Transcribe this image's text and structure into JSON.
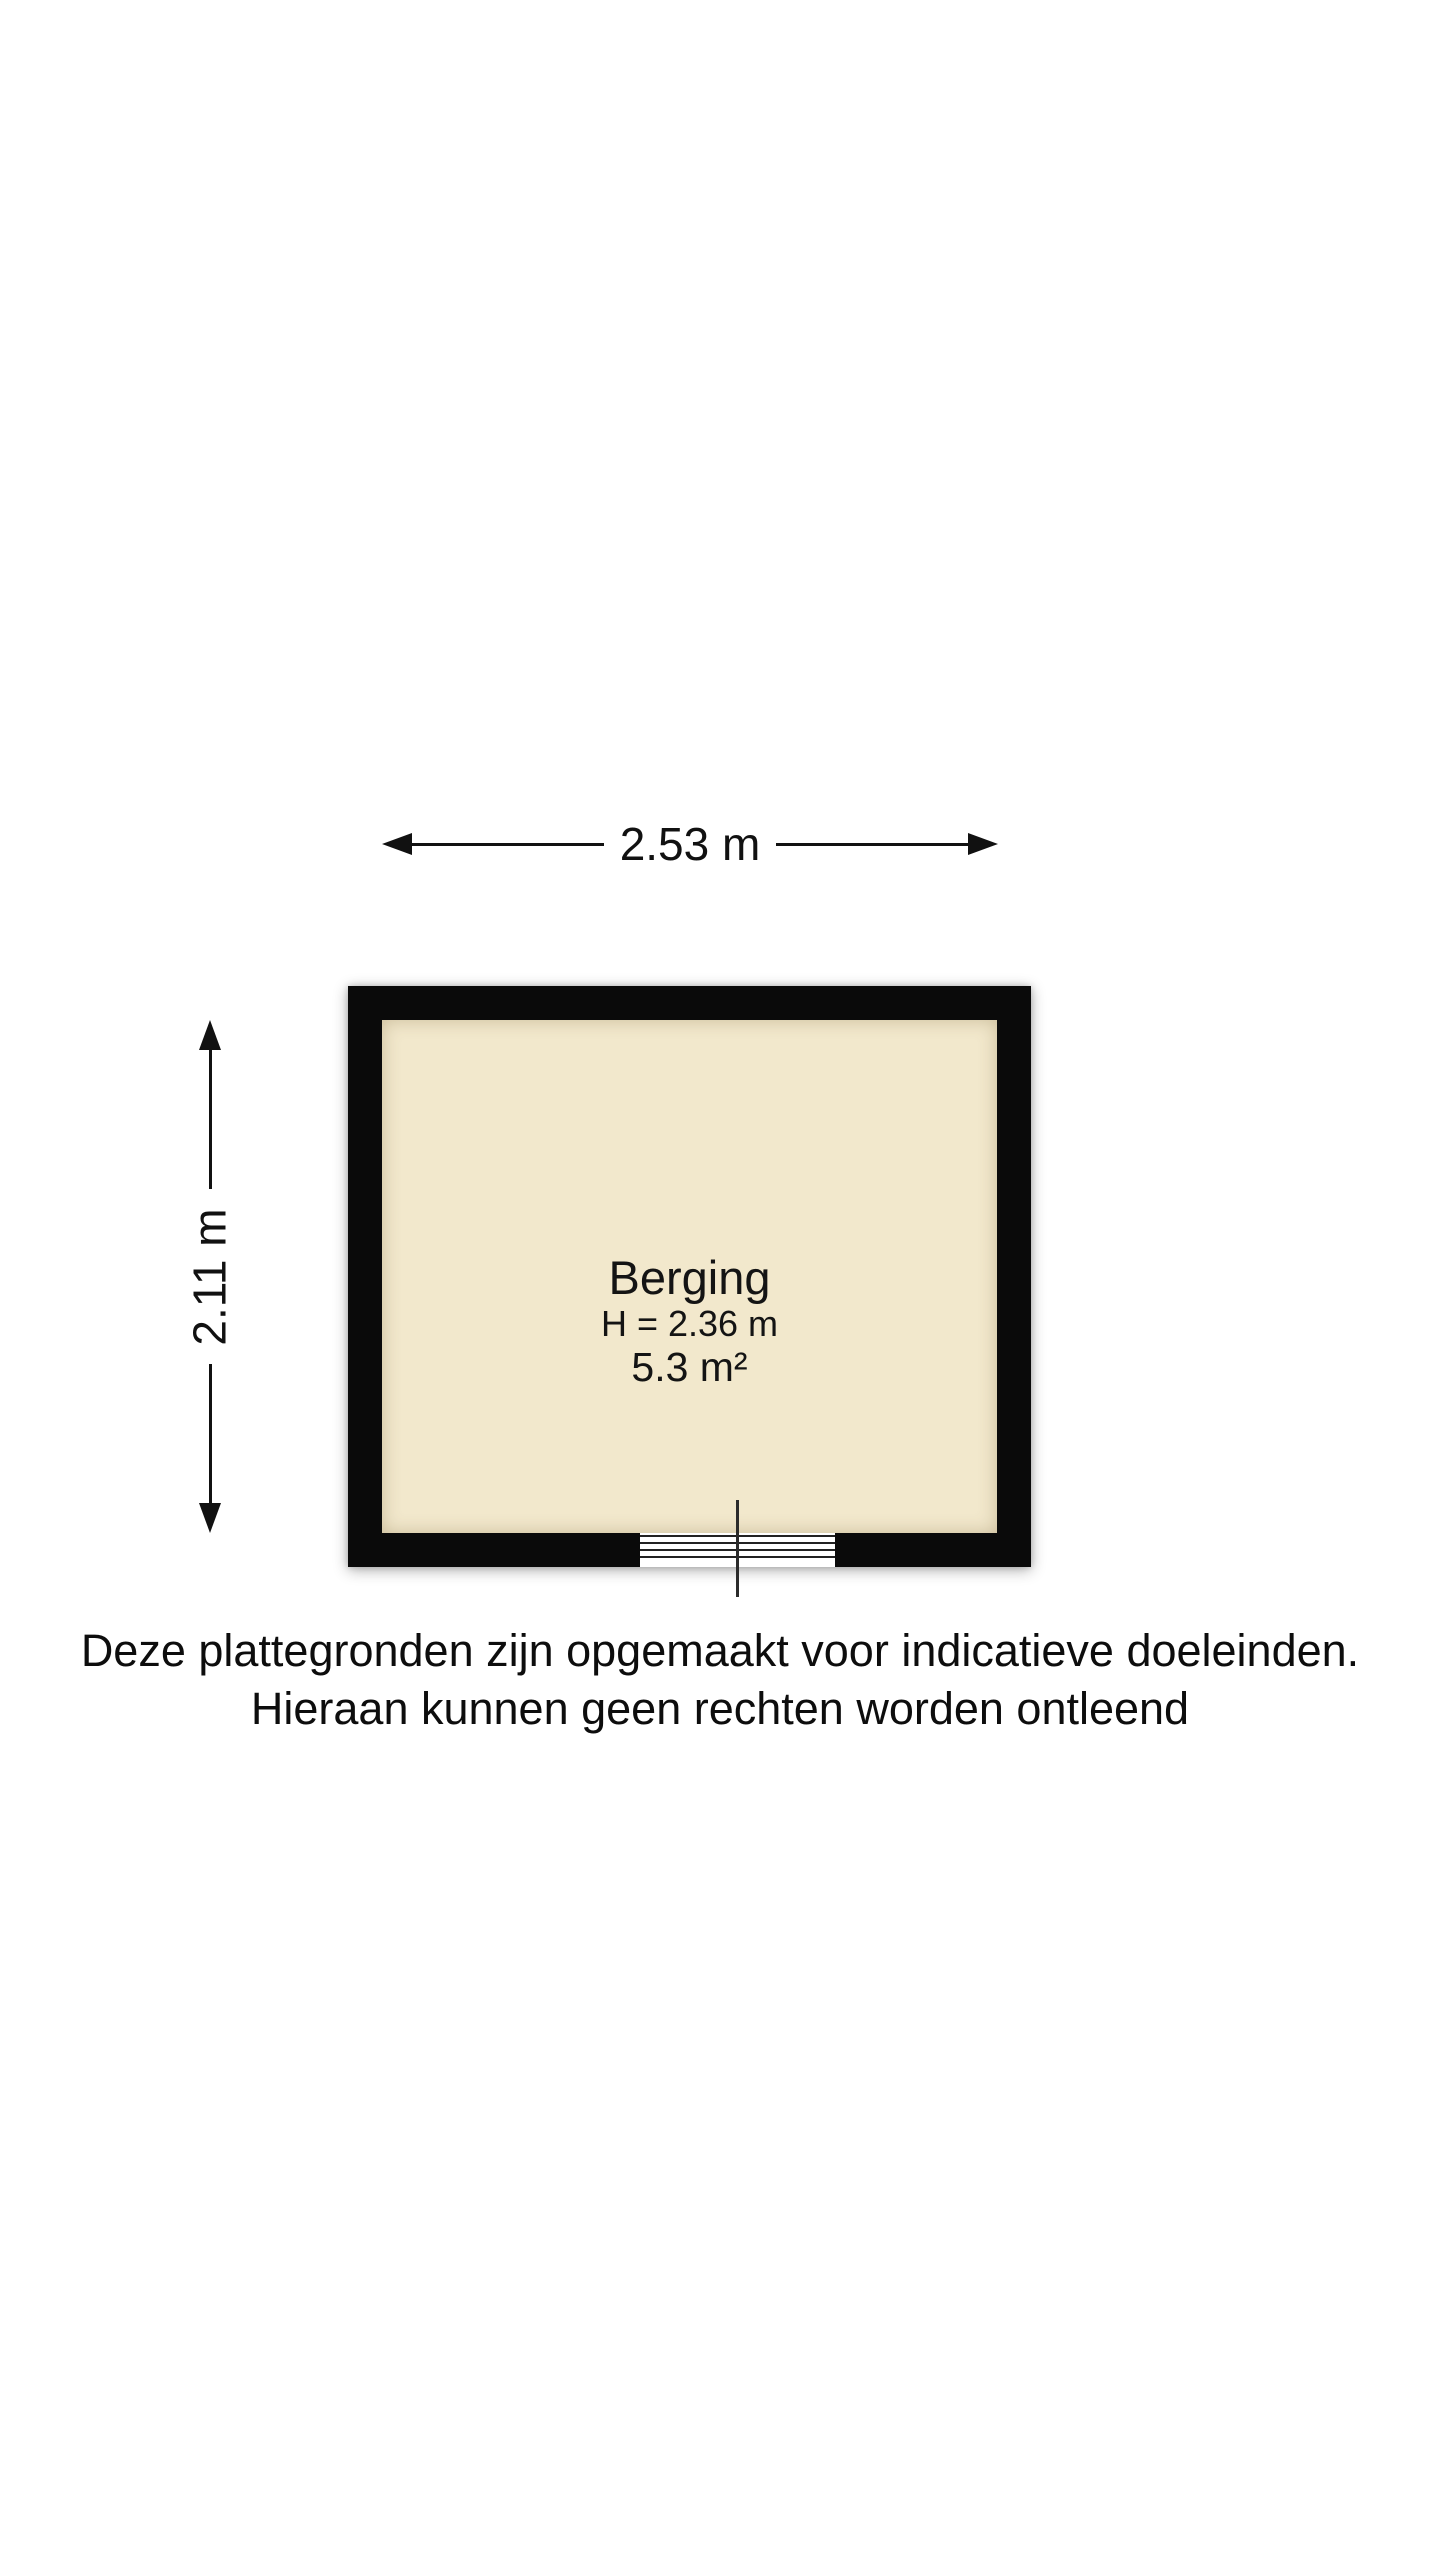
{
  "floorplan": {
    "room": {
      "name": "Berging",
      "ceiling_height_label": "H = 2.36 m",
      "area_label": "5.3 m²"
    },
    "dimensions": {
      "width_label": "2.53 m",
      "height_label": "2.11 m"
    },
    "colors": {
      "wall": "#0a0a0a",
      "floor": "#f2e8cc",
      "background": "#ffffff",
      "text": "#111111"
    }
  },
  "disclaimer": {
    "line1": "Deze plattegronden zijn opgemaakt voor indicatieve doeleinden.",
    "line2": "Hieraan kunnen geen rechten worden ontleend"
  }
}
